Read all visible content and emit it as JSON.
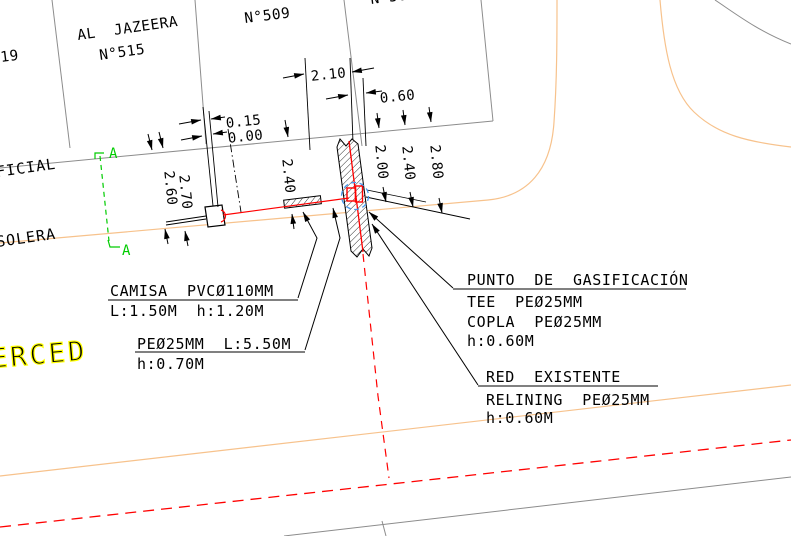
{
  "drawing": {
    "lots": {
      "lot_519_partial": "19",
      "lot_515_name": "AL  JAZEERA",
      "lot_515_num": "N°515",
      "lot_509": "N°509",
      "lot_top_partial": "N°50"
    },
    "streets": {
      "oficial_partial": "FICIAL",
      "solera": "SOLERA",
      "merced_partial": "ERCED"
    },
    "section": {
      "top": "A",
      "bottom": "A"
    },
    "dims": {
      "d210": "2.10",
      "d060": "0.60",
      "d015": "0.15",
      "d000": "0.00",
      "d260": "2.60",
      "d270": "2.70",
      "d240l": "2.40",
      "d200": "2.00",
      "d240r": "2.40",
      "d280": "2.80"
    },
    "notes": {
      "camisa_title": "CAMISA  PVCØ110MM",
      "camisa_sub": "L:1.50M  h:1.20M",
      "pe_title": "PEØ25MM  L:5.50M",
      "pe_sub": "h:0.70M",
      "punto_title": "PUNTO  DE  GASIFICACIÓN",
      "punto_l1": "TEE  PEØ25MM",
      "punto_l2": "COPLA  PEØ25MM",
      "punto_l3": "h:0.60M",
      "red_title": "RED  EXISTENTE",
      "red_l1": "RELINING  PEØ25MM",
      "red_l2": "h:0.60M"
    },
    "colors": {
      "boundary_gray": "#8C8C8C",
      "solera_orange": "#F7C28C",
      "gas_red": "#FF0000",
      "section_green": "#00CC00",
      "street_yellow": "#FFFF00",
      "detail_blue": "#4697EC"
    }
  }
}
